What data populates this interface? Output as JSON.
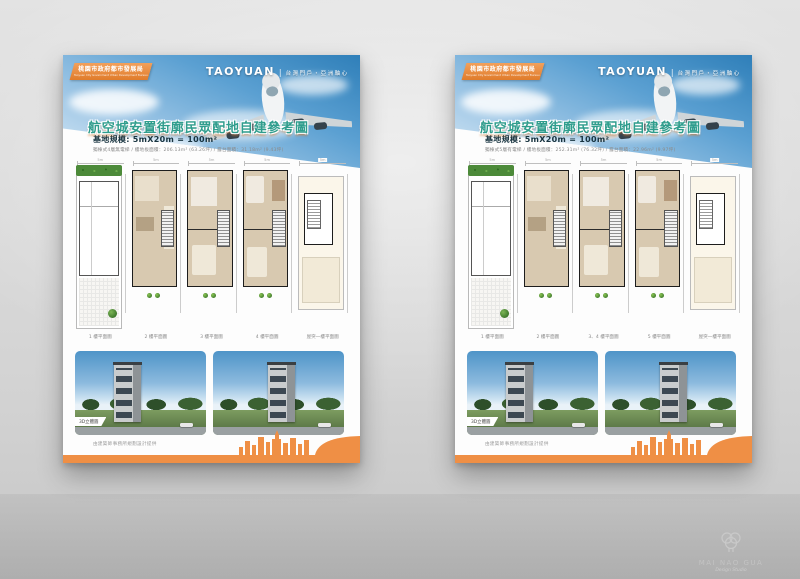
{
  "scene": {
    "background_color": "#d6d6d6",
    "accent_orange": "#ee8a3e",
    "accent_teal": "#2f9d8d",
    "sky_blue": "#4e94c8"
  },
  "watermark": {
    "icon": "brain-icon",
    "brand": "MAI NAO GUA",
    "subtitle": "Design Studio"
  },
  "posters": [
    {
      "header": {
        "bureau": "桃園市政府都市發展局",
        "bureau_en": "Taoyuan City Government Urban Development Bureau",
        "brand": "TAOYUAN",
        "divider": "|",
        "tagline": "台灣門戶・亞洲軸心",
        "title": "航空城安置街廓民眾配地自建參考圖"
      },
      "specs": {
        "scale": "基地規模: 5mX20m = 100m²",
        "detail": "獨棟式4層無電梯 / 樓地板面積：206.13m² (63.26坪) / 露台面積：31.18m² (9.43坪)"
      },
      "plans": [
        {
          "label": "1 樓平面圖",
          "dim": "5m"
        },
        {
          "label": "2 樓平面圖",
          "dim": "5m"
        },
        {
          "label": "3 樓平面圖",
          "dim": "5m"
        },
        {
          "label": "4 樓平面圖",
          "dim": "5m"
        },
        {
          "label": "屋突一樓平面圖",
          "dim": "5m"
        }
      ],
      "renders": {
        "tag": "3D立體圖",
        "credit": "由建築師事務所規劃設計提供"
      }
    },
    {
      "header": {
        "bureau": "桃園市政府都市發展局",
        "bureau_en": "Taoyuan City Government Urban Development Bureau",
        "brand": "TAOYUAN",
        "divider": "|",
        "tagline": "台灣門戶・亞洲軸心",
        "title": "航空城安置街廓民眾配地自建參考圖"
      },
      "specs": {
        "scale": "基地規模: 5mX20m = 100m²",
        "detail": "獨棟式5層有電梯 / 樓地板面積：252.31m² (76.32坪) / 露台面積：22.96m² (9.97坪)"
      },
      "plans": [
        {
          "label": "1 樓平面圖",
          "dim": "5m"
        },
        {
          "label": "2 樓平面圖",
          "dim": "5m"
        },
        {
          "label": "3、4 樓平面圖",
          "dim": "5m"
        },
        {
          "label": "5 樓平面圖",
          "dim": "5m"
        },
        {
          "label": "屋突一樓平面圖",
          "dim": "5m"
        }
      ],
      "renders": {
        "tag": "3D立體圖",
        "credit": "由建築師事務所規劃設計提供"
      }
    }
  ]
}
